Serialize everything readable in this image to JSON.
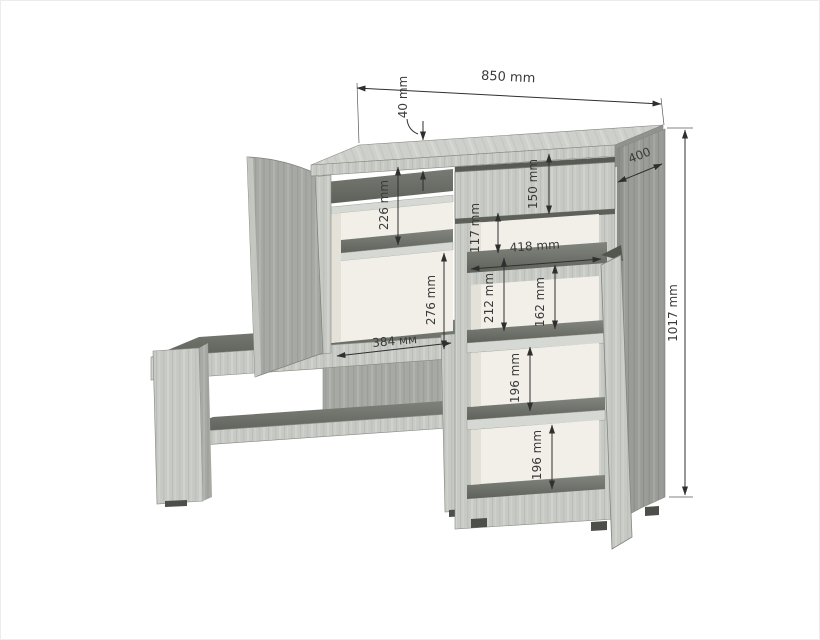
{
  "drawing": {
    "type": "furniture-technical-drawing",
    "description": "3D dimension drawing of hallway unit: bench with shelf, upper cabinet with open door, tall side cabinet with drawer front, open niche and shelved door compartment",
    "units": "mm",
    "labels": {
      "total_width": "850 mm",
      "top_thickness": "40 mm",
      "depth": "400",
      "total_height": "1017 mm",
      "drawer_height": "150 mm",
      "niche_height": "117 mm",
      "niche_width": "418 mm",
      "hutch_upper_compartment": "226 mm",
      "hutch_lower_compartment": "276 mm",
      "hutch_inner_width": "384 мм",
      "cab_upper_outer": "212 mm",
      "cab_upper_inner": "162 mm",
      "cab_middle": "196 mm",
      "cab_lower": "196 mm"
    },
    "colors": {
      "wood_light": "#c7c9c4",
      "wood_slab": "#ced0cb",
      "wood_mid": "#a7a9a4",
      "wood_side": "#9a9d97",
      "surface_dark": "#6e716a",
      "interior_cream": "#f1efe8",
      "dimension_line": "#2f2f2f",
      "text": "#3a3a3a",
      "background": "#ffffff"
    }
  }
}
